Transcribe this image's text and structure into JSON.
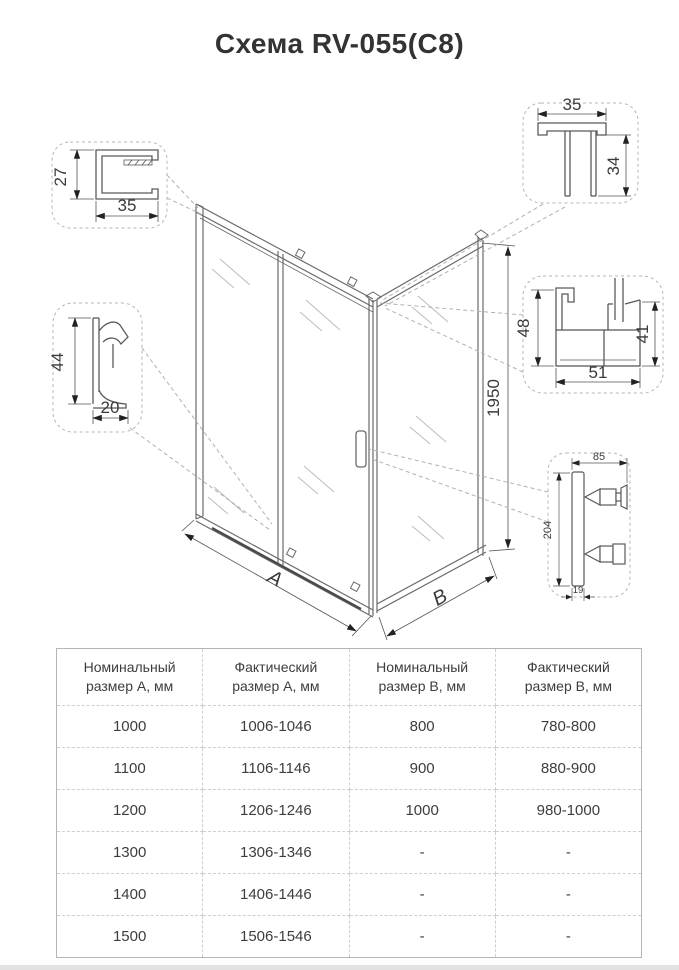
{
  "title": "Схема RV-055(C8)",
  "diagram": {
    "labels": {
      "height": "1950",
      "a": "A",
      "b": "B",
      "wall_profile_height": "27",
      "wall_profile_width": "35",
      "threshold_height": "44",
      "threshold_width": "20",
      "top_profile_width": "35",
      "top_profile_height": "34",
      "sill_left": "48",
      "sill_bottom": "51",
      "sill_right": "41",
      "handle_width": "85",
      "handle_height": "204",
      "handle_depth": "19"
    },
    "accent_color": "#1f3c5f"
  },
  "table": {
    "headers": [
      {
        "l1": "Номинальный",
        "l2": "размер A, мм"
      },
      {
        "l1": "Фактический",
        "l2": "размер A, мм"
      },
      {
        "l1": "Номинальный",
        "l2": "размер B, мм"
      },
      {
        "l1": "Фактический",
        "l2": "размер B, мм"
      }
    ],
    "rows": [
      [
        "1000",
        "1006-1046",
        "800",
        "780-800"
      ],
      [
        "1100",
        "1106-1146",
        "900",
        "880-900"
      ],
      [
        "1200",
        "1206-1246",
        "1000",
        "980-1000"
      ],
      [
        "1300",
        "1306-1346",
        "-",
        "-"
      ],
      [
        "1400",
        "1406-1446",
        "-",
        "-"
      ],
      [
        "1500",
        "1506-1546",
        "-",
        "-"
      ]
    ]
  }
}
